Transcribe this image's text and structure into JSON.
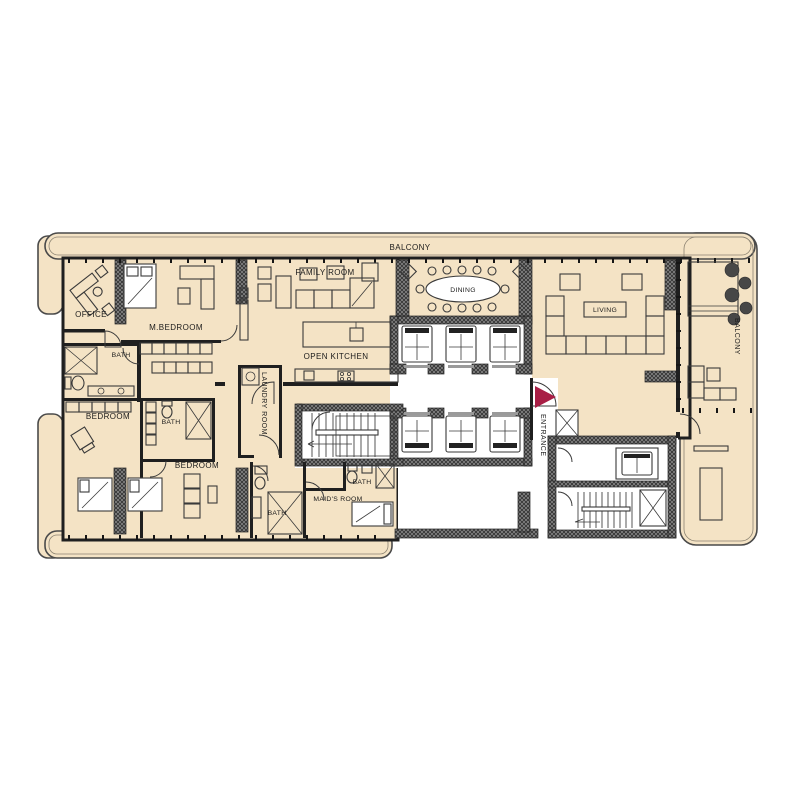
{
  "labels": {
    "balcony_top": "BALCONY",
    "family_room": "FAMILY ROOM",
    "dining": "DINING",
    "living": "LIVING",
    "office": "OFFICE",
    "m_bedroom": "M.BEDROOM",
    "bath_master": "BATH",
    "open_kitchen": "OPEN KITCHEN",
    "laundry_room": "LAUNDRY ROOM",
    "bedroom_left": "BEDROOM",
    "bath_center": "BATH",
    "bedroom_bottom": "BEDROOM",
    "bath_bottom": "BATH",
    "maids_room": "MAID'S ROOM",
    "bath_maid": "BATH",
    "entrance": "ENTRANCE",
    "balcony_right": "BALCONY"
  },
  "colors": {
    "floor": "#f4e3c5",
    "wall": "#1f1f1f",
    "entrance_arrow": "#a81e45",
    "background": "#ffffff"
  }
}
